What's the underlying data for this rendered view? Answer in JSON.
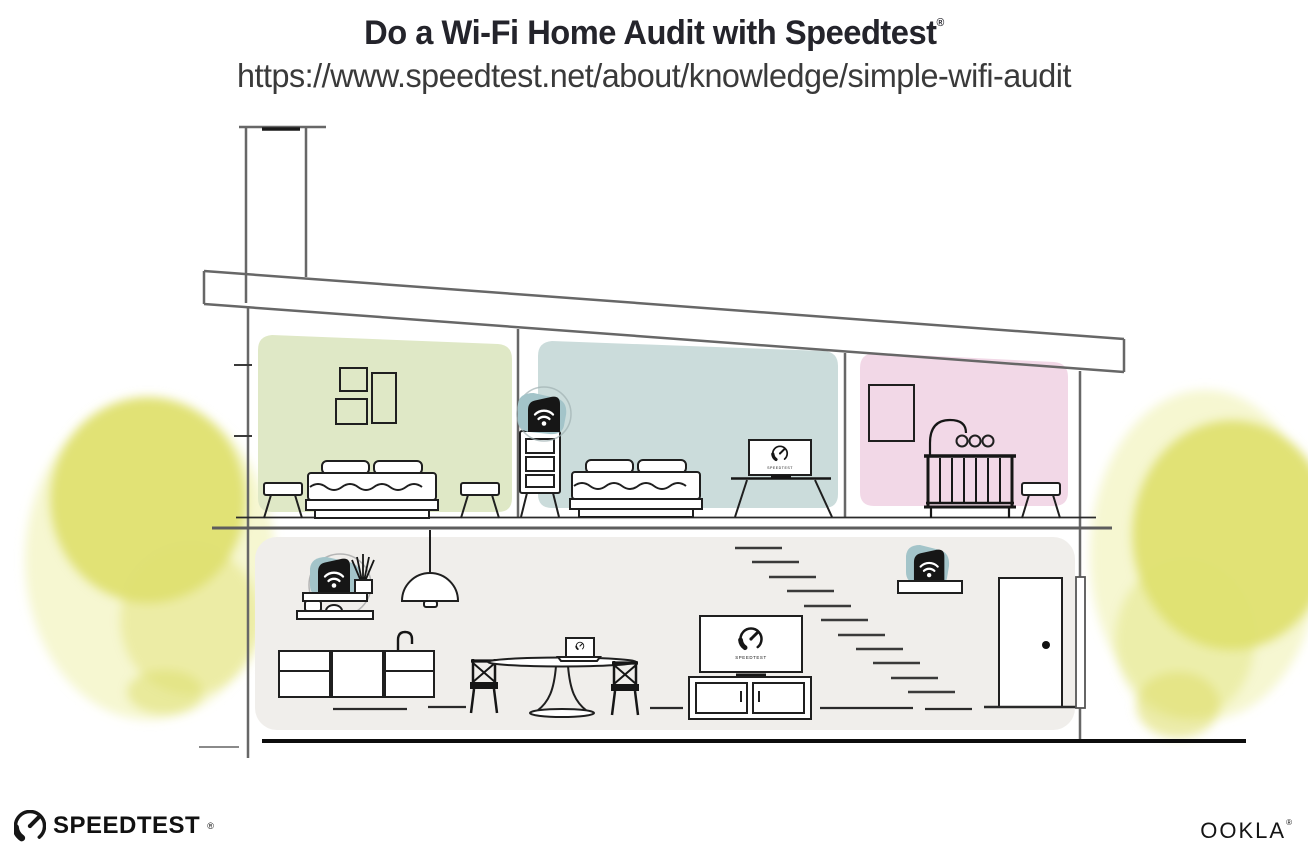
{
  "header": {
    "title": "Do a Wi-Fi Home Audit with Speedtest",
    "registered": "®",
    "url": "https://www.speedtest.net/about/knowledge/simple-wifi-audit"
  },
  "house": {
    "screen_label": "SPEEDTEST"
  },
  "footer": {
    "speedtest": "SPEEDTEST",
    "speedtest_registered": "®",
    "ookla": "OOKLA",
    "ookla_registered": "®"
  },
  "icons": {
    "wifi_mesh_device": "black fin-shaped mesh router with white wifi waves",
    "speedtest_gauge": "circular speedometer dial with needle"
  },
  "colors": {
    "room_green": "#dfe8c6",
    "room_blue": "#cbdcdb",
    "room_pink": "#f2d8e7",
    "floor_gray": "#f0eeeb",
    "highlight_teal": "#a3c4c9",
    "tree_yellow": "#dfe070",
    "tree_yellow_light": "#eef0ac",
    "ink": "#161616"
  }
}
